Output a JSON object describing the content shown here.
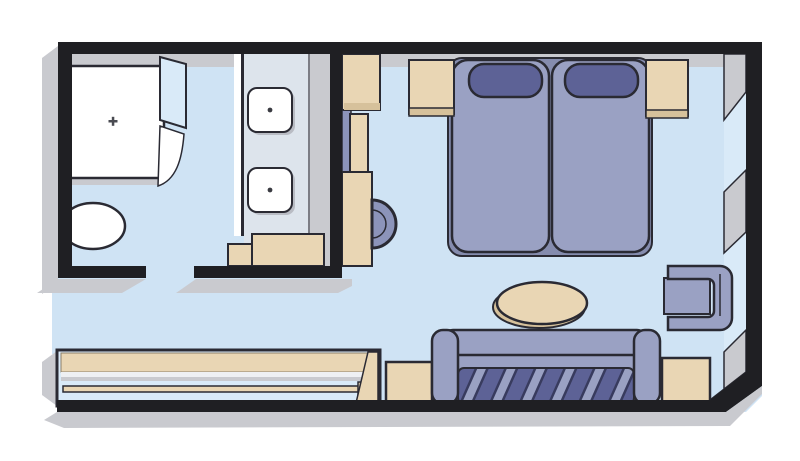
{
  "title": "cabin-floor-plan",
  "colors": {
    "background": "#ffffff",
    "wall": "#1f1f23",
    "outline": "#2a2a33",
    "floor": "#cfe3f4",
    "window": "#d9eaf8",
    "face": "#c9cacf",
    "counter": "#dde4ec",
    "fixture_white": "#ffffff",
    "wood": "#e9d6b4",
    "wood_shade": "#d6c19b",
    "upholstery": "#9aa1c3",
    "upholstery_dark": "#5d6296",
    "upholstery_mid": "#8c94ba",
    "bed_base": "#858cae",
    "thin_line": "#7c7d85"
  },
  "plan": {
    "rooms": [
      "bathroom",
      "vanity-nook",
      "entrance-hall",
      "bedroom-sitting-area"
    ],
    "fixtures": [
      "shower",
      "shower-glass-door",
      "toilet",
      "vanity-counter",
      "sink",
      "sink",
      "under-sink-cabinet"
    ],
    "furniture": [
      "wardrobe",
      "dressing-desk",
      "stool",
      "twin-bed",
      "twin-bed",
      "pillow",
      "pillow",
      "nightstand-left",
      "nightstand-right",
      "oval-table",
      "armchair",
      "sofa",
      "side-table-left",
      "side-table-right",
      "closet-unit",
      "closet-rod"
    ],
    "architecture": [
      "outer-walls",
      "divider-wall",
      "bathroom-doorway",
      "entrance-opening",
      "window-upper",
      "window-lower",
      "wall-pillar",
      "chamfered-corner"
    ]
  }
}
